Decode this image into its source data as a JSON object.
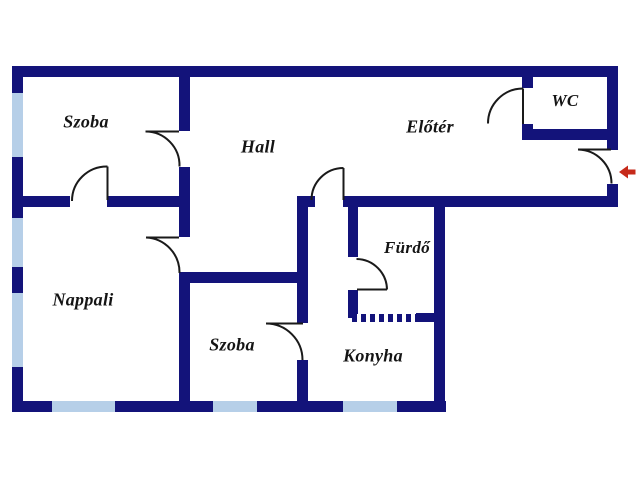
{
  "floorplan": {
    "rooms": [
      {
        "id": "szoba-1",
        "label": "Szoba"
      },
      {
        "id": "hall",
        "label": "Hall"
      },
      {
        "id": "eloter",
        "label": "Előtér"
      },
      {
        "id": "wc",
        "label": "WC"
      },
      {
        "id": "nappali",
        "label": "Nappali"
      },
      {
        "id": "furdo",
        "label": "Fürdő"
      },
      {
        "id": "szoba-2",
        "label": "Szoba"
      },
      {
        "id": "konyha",
        "label": "Konyha"
      }
    ],
    "colors": {
      "wall": "#13137a",
      "window": "#b6cfe8",
      "door_line": "#1a1a1a",
      "entrance_arrow": "#c62a1a",
      "background": "#ffffff"
    },
    "entrance": {
      "arrow_direction": "left",
      "location": "right-wall"
    },
    "window_count": 6,
    "door_count": 8
  }
}
